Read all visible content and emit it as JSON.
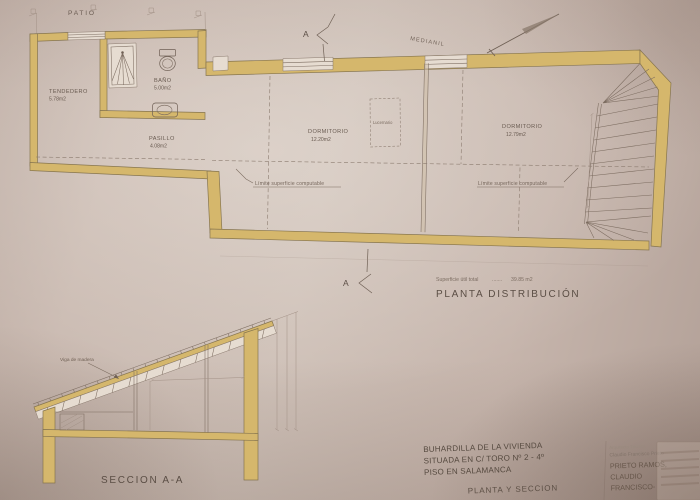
{
  "plan": {
    "patio": "PATIO",
    "medianil": "MEDIANIL",
    "section_marker": "A",
    "rooms": {
      "tendedero": {
        "name": "TENDEDERO",
        "area": "5.78m2"
      },
      "bano": {
        "name": "BAÑO",
        "area": "5.00m2"
      },
      "pasillo": {
        "name": "PASILLO",
        "area": "4.08m2"
      },
      "dormitorio1": {
        "name": "DORMITORIO",
        "area": "12.20m2"
      },
      "dormitorio2": {
        "name": "DORMITORIO",
        "area": "12.79m2"
      }
    },
    "lucernario": "Lucernario",
    "limit_left": "Límite superficie computable",
    "limit_right": "Límite superficie computable",
    "total_label": "Superficie útil total",
    "total_dots": ".......",
    "total_value": "39.85 m2",
    "title": "PLANTA DISTRIBUCIÓN"
  },
  "section": {
    "beam_label": "Viga de madera",
    "title": "SECCION A-A"
  },
  "titleblock": {
    "project_line1": "BUHARDILLA DE LA VIVIENDA",
    "project_line2": "SITUADA EN C/ TORO Nº 2 - 4º",
    "project_line3": "PISO EN SALAMANCA",
    "drawing_title": "PLANTA Y SECCION",
    "architect_small1": "Arquitecto Técnico",
    "architect_small2": "Claudio Francisco Prieto",
    "architect_name1": "PRIETO RAMOS,",
    "architect_name2": "CLAUDIO",
    "architect_name3": "FRANCISCO-"
  },
  "colors": {
    "paper": "#c8b8af",
    "wall_fill": "#d5b76c",
    "ink": "#5d5149"
  },
  "icons": {
    "north_arrow": "compass-needle",
    "shower": "shower-stall",
    "toilet": "toilet",
    "sink": "washbasin",
    "stairs": "winder-staircase"
  }
}
